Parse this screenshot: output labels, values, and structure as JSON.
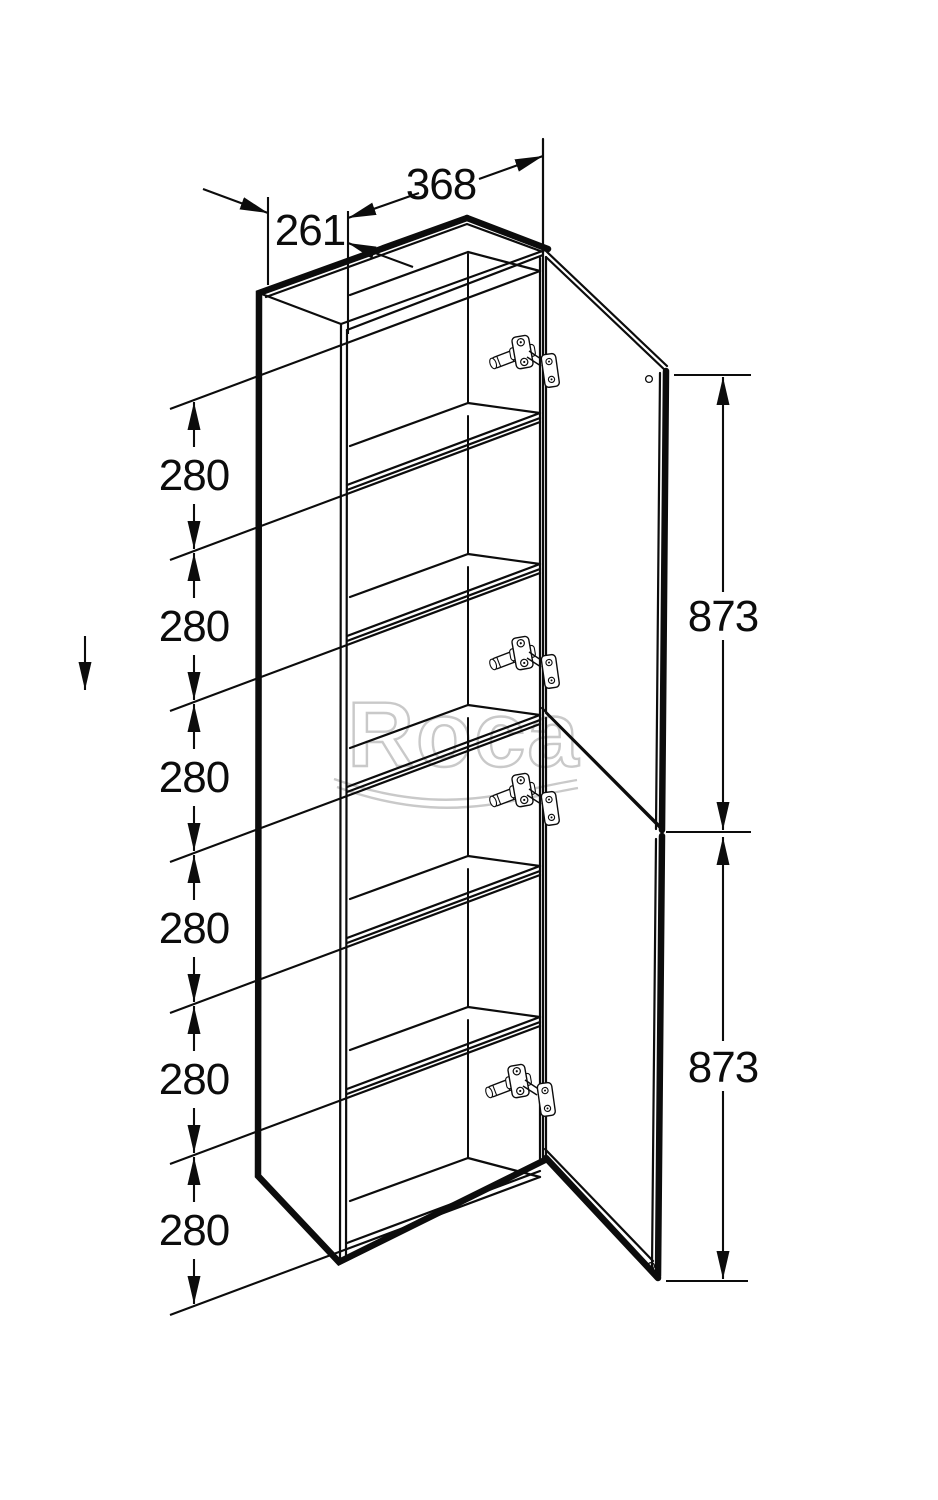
{
  "drawing": {
    "type": "cabinet-dimension-diagram",
    "brand_watermark": "Roca",
    "dimensions": {
      "depth": "261",
      "width": "368",
      "upper_door_height": "873",
      "lower_door_height": "873",
      "shelf_spacings": [
        "280",
        "280",
        "280",
        "280",
        "280",
        "280"
      ]
    }
  }
}
